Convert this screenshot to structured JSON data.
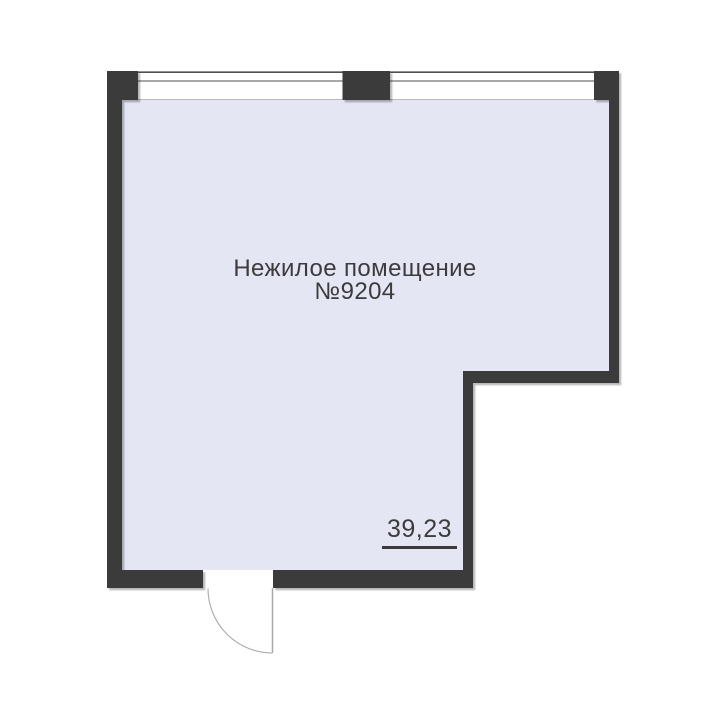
{
  "floorplan": {
    "room": {
      "name_line1": "Нежилое помещение",
      "name_line2": "№9204",
      "area_value": "39,23"
    },
    "colors": {
      "background": "#ffffff",
      "wall": "#3a3a3a",
      "floor_fill": "#e4e6f4",
      "window_line": "#4f4f4f",
      "window_sill_line": "#b9bac6",
      "door_line": "#a9a9a9",
      "label_text": "#3c3c3c",
      "area_underline": "#3a3a3a"
    }
  }
}
